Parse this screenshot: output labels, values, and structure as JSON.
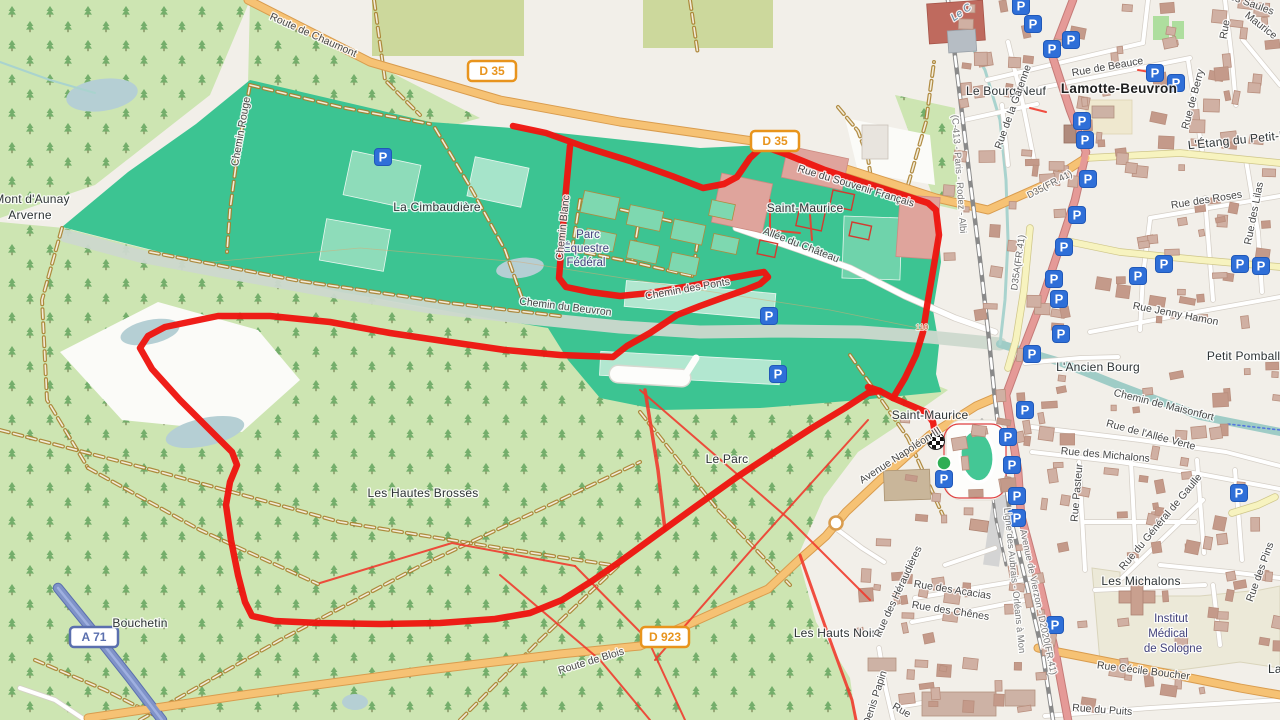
{
  "map": {
    "attribution_visible": false,
    "type": "openstreetmap-with-gps-route"
  },
  "palette": {
    "background": "#f2efe9",
    "forest": "#cde5b2",
    "tree": "#74ae6b",
    "park_teal": "#3cc492",
    "park_light": "#8edcba",
    "park_strip": "#b2e7d0",
    "water": "#9fccc6",
    "river_band": "#ccd8ce",
    "lake": "#b5cfd4",
    "route_red": "#ee1510",
    "trail_red": "#ef3b2d",
    "track_brown": "#a8802f",
    "road_orange": "#f6c274",
    "road_orange_casing": "#d99c4e",
    "road_yellow": "#f7f3bf",
    "road_yellow_casing": "#cfc68a",
    "road_pink": "#e59a97",
    "road_pink_casing": "#c47b78",
    "road_white": "#ffffff",
    "road_white_casing": "#d5cfc7",
    "motorway_blue": "#8093c8",
    "motorway_casing": "#5a6fae",
    "railway_grey": "#8a8a8a",
    "building": "#d0b0a3",
    "building_stroke": "#b98f7e",
    "parking_blue": "#2f6fd8",
    "hospital_beige": "#ece9d8",
    "orchard_olive": "#ccd89c",
    "start_green": "#2fae54"
  },
  "icons": {
    "parking_glyph": "P"
  },
  "shields": {
    "d35_1": "D 35",
    "d35_2": "D 35",
    "d923": "D 923",
    "a71": "A 71"
  },
  "markers": {
    "start": "route-start",
    "finish": "route-finish"
  },
  "labels": {
    "route_de_chaumont": "Route de Chaumont",
    "chemin_rouge": "Chemin Rouge",
    "la_cimbaudiere": "La Cimbaudière",
    "parc_equestre_l1": "Parc",
    "parc_equestre_l2": "Équestre",
    "parc_equestre_l3": "Fédéral",
    "saint_maurice_park": "Saint-Maurice",
    "allee_du_chateau": "Allée du Château",
    "rue_du_souvenir": "Rue du Souvenir Français",
    "chemin_du_beuvron": "Chemin du Beuvron",
    "chemin_des_ponts": "Chemin des Ponts",
    "chemin_blanc": "Chemin Blanc",
    "le_stream": "Le C",
    "le_bourg_neuf": "Le Bourg Neuf",
    "rue_de_la_garenne": "Rue de la Garenne",
    "rue_de_beauce": "Rue de Beauce",
    "lamotte_beuvron": "Lamotte-Beuvron",
    "rue_de_berry": "Rue de Berry",
    "etang_petit": "L'Étang du Petit-P",
    "rue_des_roses": "Rue des Roses",
    "rue_des_lilas": "Rue des Lilas",
    "rue_jenny_hamon": "Rue Jenny Hamon",
    "d35a_ref": "D35A(FR.41)",
    "d35_ref": "D35(FR.41)",
    "railway_ic": "(C-413 - Paris - Rodez - Albi",
    "lancien_bourg": "L'Ancien Bourg",
    "chemin_maisonfort": "Chemin de Maisonfort",
    "petit_pomballe": "Petit Pomballe",
    "rue_allee_verte": "Rue de l'Allée Verte",
    "rue_michalons": "Rue des Michalons",
    "rue_pasteur": "Rue Pasteur",
    "rue_general_de_gaulle": "Rue du Général de Gaulle",
    "les_michalons": "Les Michalons",
    "institut_l1": "Institut",
    "institut_l2": "Médical",
    "institut_l3": "de Sologne",
    "rue_cecile": "Rue Cécile Boucher",
    "rue_du_puits": "Rue du Puits",
    "la_frag": "La G",
    "rue_des_pins": "Rue des Pins",
    "ligne_aubrais": "Ligne des Aubrais - Orléans à Mon",
    "av_vierzon": "Avenue de Vierzon - D2020(FR.41)",
    "les_hauts_noirs": "Les Hauts Noirs",
    "heraudieres": "Rue des Héraudières",
    "rue_acacias": "Rue des Acacias",
    "rue_chenes": "Rue des Chênes",
    "denis_papin": "Denis Papin",
    "rue_frag_bottom": "Rue",
    "bouchetin": "Bouchetin",
    "route_de_blois": "Route de Blois",
    "mont_daunay_l1": "Mont d'Aunay",
    "mont_daunay_l2": "Arverne",
    "les_hautes_brosses": "Les Hautes Brosses",
    "le_parc": "Le Parc",
    "av_napoleon": "Avenue Napoléon III",
    "saint_maurice_town": "Saint-Maurice",
    "contour110": "110",
    "rue_frag_tr": "Rue",
    "maurice_frag": "Maurice",
    "saules_frag": "Les Saules"
  }
}
